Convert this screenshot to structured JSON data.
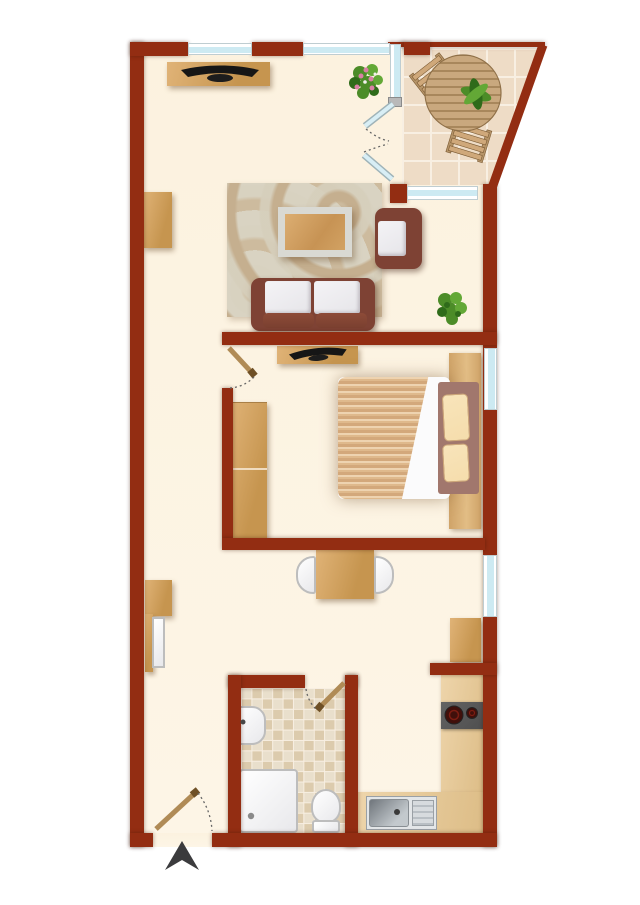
{
  "document": {
    "kind": "apartment-floor-plan",
    "visible_text": []
  },
  "palette": {
    "wall": "#932d12",
    "floor": "#fcf2df",
    "tile": "#eedcc6",
    "grout": "#f8efe2",
    "bathtile1": "#e9dfcc",
    "bathtile2": "#dccbad",
    "glass": "#cdeaf2",
    "wood1": "#e0b377",
    "wood2": "#c6954f",
    "counter1": "#eed5ab",
    "counter2": "#ddbd87",
    "rugbase": "#d9d3c2",
    "rugswirl1": "#c5af8f",
    "rugswirl2": "#cdbb9e",
    "sofa": "#7e4234",
    "cushion": "#e6e5e9",
    "mauve": "#a1776d",
    "pillow": "#f5ddac",
    "duveta": "#eed3b0",
    "duvetb": "#dfb98c",
    "duvetc": "#d3a87b",
    "plank1": "#cfa368",
    "plank2": "#e2bd85",
    "tv": "#161616",
    "plantA": "#4c8c28",
    "plantB": "#63a836",
    "plantC": "#2f6b1a",
    "flower": "#d980a5",
    "stove": "#4f4f4f",
    "burner": "#40100b",
    "arrow": "#3b3b3d",
    "doorwood": "#b08b56",
    "arc": "#666666",
    "outline": "#bdbdbd"
  },
  "rooms": {
    "balcony": {
      "floor": "tiles",
      "furniture": [
        "round-table",
        "chair",
        "chair",
        "potted-plant"
      ]
    },
    "living_room": {
      "floor": "parquet-cream",
      "furniture": [
        "tv-sideboard",
        "flowering-plant",
        "rug",
        "coffee-table",
        "armchair",
        "sofa",
        "potted-plant"
      ],
      "openings": [
        "window",
        "window",
        "french-doors-to-balcony",
        "balcony-window"
      ]
    },
    "bedroom": {
      "furniture": [
        "tv-sideboard",
        "wardrobe",
        "double-bed"
      ],
      "openings": [
        "door",
        "window"
      ]
    },
    "hall": {
      "furniture": [
        "wall-cabinet",
        "dining-table",
        "chair",
        "chair",
        "coat-cabinet-open"
      ],
      "openings": [
        "entrance-door",
        "window"
      ]
    },
    "bathroom": {
      "floor": "mosaic-tiles",
      "furniture": [
        "washbasin",
        "shower",
        "toilet"
      ],
      "openings": [
        "door"
      ]
    },
    "kitchen": {
      "furniture": [
        "wall-cabinet",
        "worktop",
        "cooktop",
        "sink-unit"
      ]
    }
  },
  "symbols": [
    "north-entrance-arrow",
    "door-swing-arcs"
  ]
}
